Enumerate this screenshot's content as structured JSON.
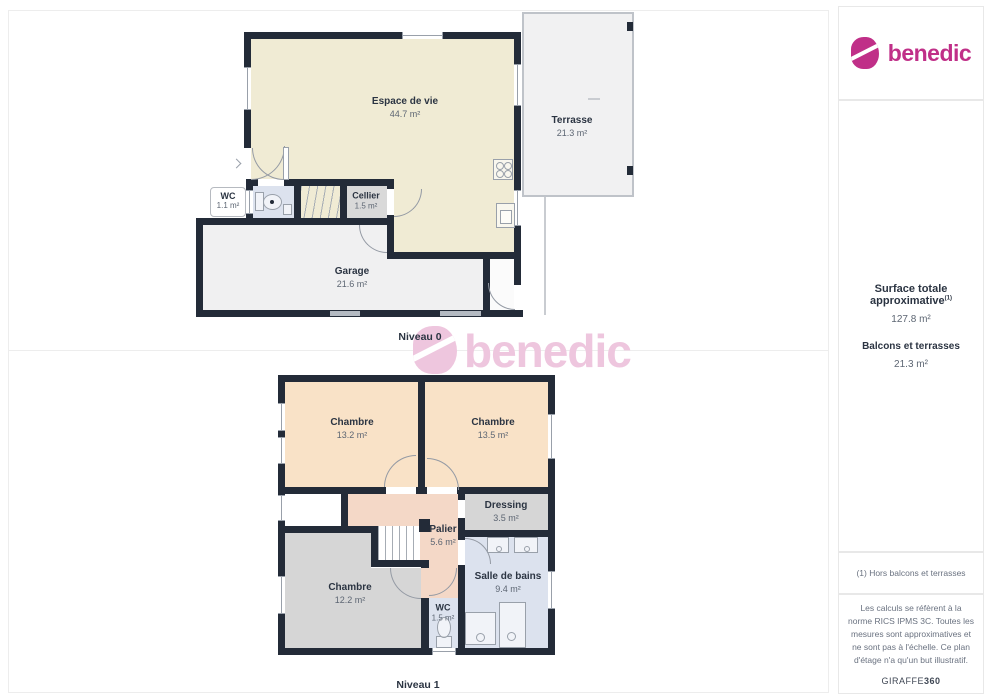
{
  "brand": {
    "name": "benedic",
    "color": "#c02f88"
  },
  "watermark": {
    "text": "benedic"
  },
  "sidebar": {
    "surface_title": "Surface totale approximative",
    "surface_sup": "(1)",
    "surface_value": "127.8 m²",
    "balconies_label": "Balcons et terrasses",
    "balconies_value": "21.3 m²",
    "footnote": "(1) Hors balcons et terrasses",
    "legal": "Les calculs se réfèrent à la norme RICS IPMS 3C. Toutes les mesures sont approximatives et ne sont pas à l'échelle. Ce plan d'étage n'a qu'un but illustratif.",
    "credit_name": "GIRAFFE",
    "credit_number": "360"
  },
  "levels": [
    {
      "name": "Niveau 0",
      "rooms": [
        {
          "label": "Espace de vie",
          "area": "44.7 m²"
        },
        {
          "label": "Terrasse",
          "area": "21.3 m²"
        },
        {
          "label": "WC",
          "area": "1.1 m²"
        },
        {
          "label": "Cellier",
          "area": "1.5 m²"
        },
        {
          "label": "Garage",
          "area": "21.6 m²"
        }
      ]
    },
    {
      "name": "Niveau 1",
      "rooms": [
        {
          "label": "Chambre",
          "area": "13.2 m²"
        },
        {
          "label": "Chambre",
          "area": "13.5 m²"
        },
        {
          "label": "Dressing",
          "area": "3.5 m²"
        },
        {
          "label": "Palier",
          "area": "5.6 m²"
        },
        {
          "label": "Salle de bains",
          "area": "9.4 m²"
        },
        {
          "label": "Chambre",
          "area": "12.2 m²"
        },
        {
          "label": "WC",
          "area": "1.5 m²"
        }
      ]
    }
  ]
}
